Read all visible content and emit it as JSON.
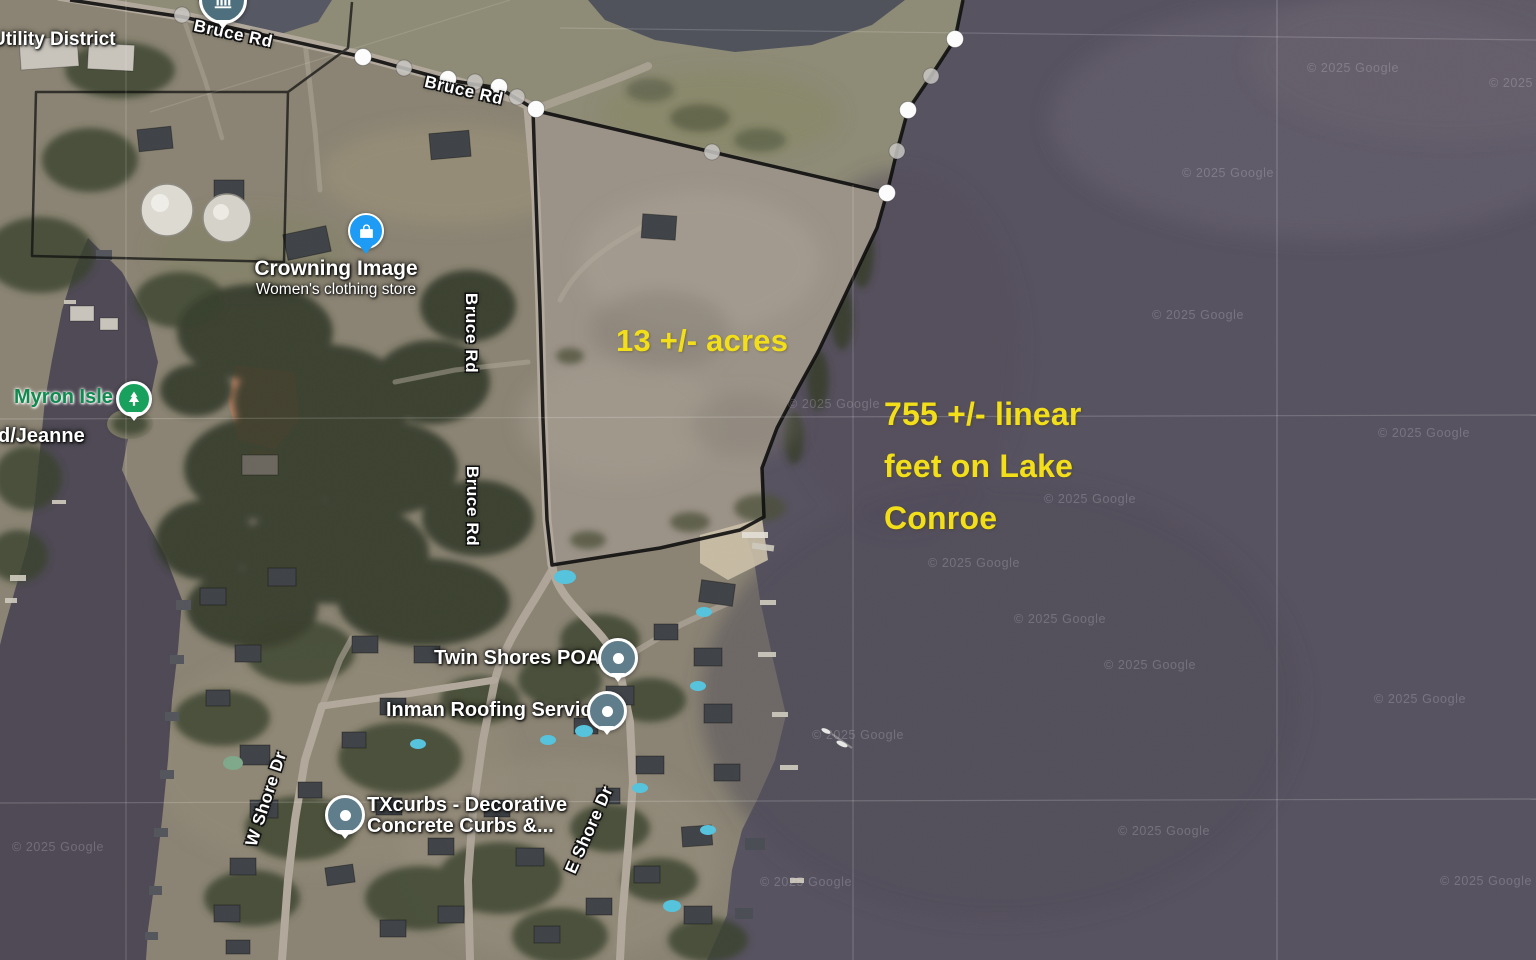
{
  "attribution": "© 2025 Google",
  "annotations": {
    "acreage": "13 +/- acres",
    "waterfront": [
      "755 +/- linear",
      "feet on Lake",
      "Conroe"
    ],
    "color": "#F2DF1A"
  },
  "labels": {
    "utility_district": "Utility District",
    "bruce_rd": "Bruce Rd",
    "crowning_image_title": "Crowning Image",
    "crowning_image_subtitle": "Women's clothing store",
    "myron_isle": "Myron Isle",
    "jeanne": "d/Jeanne",
    "twin_shores_poa": "Twin Shores POA",
    "inman_roofing": "Inman Roofing Services",
    "txcurbs_line1": "TXcurbs - Decorative",
    "txcurbs_line2": "Concrete Curbs &...",
    "w_shore_dr": "W Shore Dr",
    "e_shore_dr": "E Shore Dr"
  },
  "pins": {
    "utility_district_icon": "building-icon",
    "crowning_image_icon": "shopping-bag-icon",
    "myron_isle_icon": "tree-icon",
    "twin_shores_icon": "poi-dot-icon",
    "inman_roofing_icon": "poi-dot-icon",
    "txcurbs_icon": "poi-dot-icon"
  },
  "colors": {
    "water": "#575260",
    "land": "#8B8474",
    "field": "#9C9388",
    "boundary": "#0D0D0D",
    "poi_pin": "#5F7D8B",
    "store_pin": "#1D9BF5",
    "park_pin": "#18A15D",
    "civic_pin": "#4E707E"
  }
}
